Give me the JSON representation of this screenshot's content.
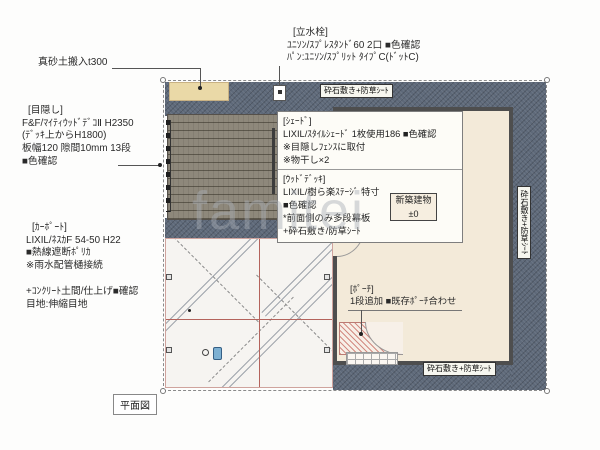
{
  "drawing_title": "平面図",
  "watermark": "famitei",
  "colors": {
    "gravel": "#5e6979",
    "deck": "#8e887b",
    "house_fill": "#f3ead9",
    "wall": "#4e4e4e",
    "concrete": "#f6f4f1",
    "masado_fill": "#ead9a7",
    "porch_hatch": "#bf554b",
    "joint_red": "#b4635c",
    "drain_blue": "#7db0d2"
  },
  "notes": {
    "tap": {
      "heading": "[立水栓]",
      "lines": [
        "ﾕﾆｿﾝ/ｽﾌﾟﾚｽﾀﾝﾄﾞ60 2口 ■色確認",
        "ﾊﾟﾝ:ﾕﾆｿﾝ/ｽﾌﾟﾘｯﾄ ﾀｲﾌﾟC(ﾄﾞｯﾄC)"
      ]
    },
    "masado": {
      "text": "真砂土搬入t300"
    },
    "privacy": {
      "heading": "[目隠し]",
      "lines": [
        "F&F/ﾏｲﾃｨｳｯﾄﾞﾃﾞｺⅡ H2350",
        "(ﾃﾞｯｷ上からH1800)",
        "板幅120 隙間10mm 13段",
        "■色確認"
      ]
    },
    "carport": {
      "heading": "[ｶｰﾎﾟｰﾄ]",
      "lines": [
        "LIXIL/ﾈｽｶF 54-50 H22",
        "■熱線遮断ﾎﾟﾘｶ",
        "※雨水配管樋接続"
      ]
    },
    "concrete": {
      "lines": [
        "+ｺﾝｸﾘｰﾄ土間/仕上げ■確認",
        "目地:伸縮目地"
      ]
    },
    "shade": {
      "heading": "[ｼｪｰﾄﾞ]",
      "lines": [
        "LIXIL/ｽﾀｲﾙｼｪｰﾄﾞ 1枚使用186 ■色確認",
        "※目隠しﾌｪﾝｽに取付",
        "※物干し×2"
      ]
    },
    "wood_deck": {
      "heading": "[ｳｯﾄﾞﾃﾞｯｷ]",
      "lines": [
        "LIXIL/樹ら楽ｽﾃｰｼﾞ 特寸",
        "■色確認",
        "*前面側のみ多段幕板",
        "+砕石敷き/防草ｼｰﾄ"
      ]
    },
    "porch": {
      "heading": "[ﾎﾟｰﾁ]",
      "line": "1段追加 ■既存ﾎﾟｰﾁ合わせ"
    },
    "building": {
      "name": "新築建物",
      "level": "±0"
    },
    "gravel_label": "砕石敷き+防草ｼｰﾄ"
  }
}
